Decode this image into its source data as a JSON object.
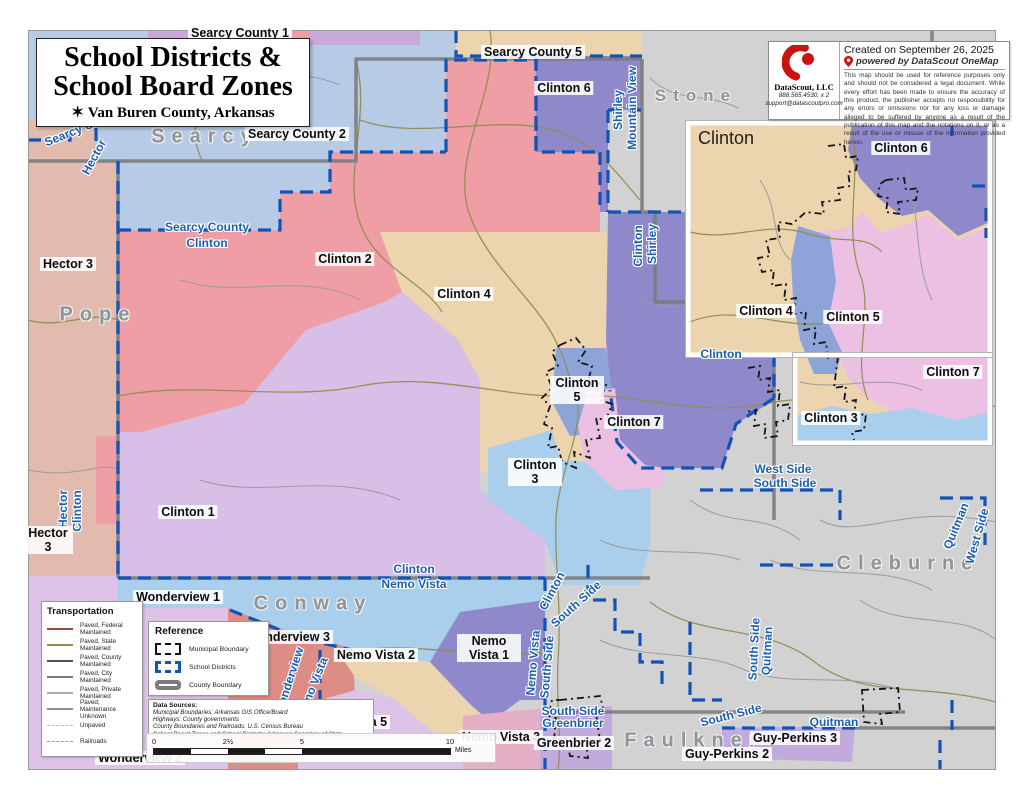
{
  "title_block": {
    "line1": "School Districts &",
    "line2": "School Board Zones",
    "north_icon": "✶",
    "subtitle": "Van Buren County, Arkansas"
  },
  "credit_block": {
    "created": "Created on September 26, 2025",
    "powered": "powered by DataScout OneMap",
    "company": "DataScout, LLC",
    "phone": "888.565.4530, x 2",
    "email": "support@datascoutpro.com",
    "disclaimer": "This map should be used for reference purposes only and should not be considered a legal document.  While every effort has been made to ensure the accuracy of this product, the publisher accepts no responsibility for any errors or omissions nor for any loss or damage alleged to be suffered by anyone as a result of the publication of this map and the notations on it, or as a result of the use or misuse of the information provided herein."
  },
  "legend_transportation": {
    "title": "Transportation",
    "items": [
      {
        "label": "Paved, Federal Maintained"
      },
      {
        "label": "Paved, State Maintained"
      },
      {
        "label": "Paved, County Maintained"
      },
      {
        "label": "Paved, City Maintained"
      },
      {
        "label": "Paved, Private Maintained"
      },
      {
        "label": "Paved, Maintenance Unknown"
      },
      {
        "label": "Unpaved"
      },
      {
        "label": "Railroads"
      }
    ]
  },
  "legend_reference": {
    "title": "Reference",
    "items": [
      {
        "label": "Municipal Boundary"
      },
      {
        "label": "School Districts"
      },
      {
        "label": "County Boundary"
      }
    ]
  },
  "data_sources": {
    "title": "Data Sources:",
    "lines": [
      "Municipal Boundaries: Arkansas GIS Office/Board",
      "Highways: County governments",
      "County Boundaries and Railroads: U.S. Census Bureau",
      "School Board Zones and School Districts: Arkansas Secretary of State"
    ]
  },
  "scale_bar": {
    "ticks": [
      "0",
      "2½",
      "5",
      "10"
    ],
    "unit": "Miles"
  },
  "county_labels": [
    {
      "text": "Searcy"
    },
    {
      "text": "Pope"
    },
    {
      "text": "Stone"
    },
    {
      "text": "Conway"
    },
    {
      "text": "Cleburne"
    },
    {
      "text": "Faulkner"
    }
  ],
  "district_labels": [
    {
      "text": "Searcy County"
    },
    {
      "text": "Hector"
    },
    {
      "text": "Searcy County"
    },
    {
      "text": "Clinton"
    },
    {
      "text": "Shirley"
    },
    {
      "text": "Mountain View"
    },
    {
      "text": "Clinton"
    },
    {
      "text": "Shirley"
    },
    {
      "text": "Hector"
    },
    {
      "text": "Clinton"
    },
    {
      "text": "Clinton"
    },
    {
      "text": "Nemo Vista"
    },
    {
      "text": "West Side"
    },
    {
      "text": "South Side"
    },
    {
      "text": "Clinton"
    },
    {
      "text": "South Side"
    },
    {
      "text": "Nemo Vista"
    },
    {
      "text": "South Side"
    },
    {
      "text": "South Side"
    },
    {
      "text": "Quitman"
    },
    {
      "text": "Quitman"
    },
    {
      "text": "West Side"
    },
    {
      "text": "South Side"
    },
    {
      "text": "Greenbrier"
    },
    {
      "text": "South Side"
    },
    {
      "text": "Quitman"
    },
    {
      "text": "Wonderview"
    },
    {
      "text": "Nemo Vista"
    }
  ],
  "zone_labels": [
    {
      "text": "Searcy County 1"
    },
    {
      "text": "Searcy County 5"
    },
    {
      "text": "Clinton 6"
    },
    {
      "text": "Searcy County 2"
    },
    {
      "text": "Clinton 2"
    },
    {
      "text": "Clinton 4"
    },
    {
      "text": "Clinton 5"
    },
    {
      "text": "Clinton 7"
    },
    {
      "text": "Clinton 3"
    },
    {
      "text": "Clinton 1"
    },
    {
      "text": "Hector 3"
    },
    {
      "text": "Hector 3"
    },
    {
      "text": "Wonderview 1"
    },
    {
      "text": "Wonderview 3"
    },
    {
      "text": "Nemo Vista 2"
    },
    {
      "text": "Nemo Vista 1"
    },
    {
      "text": "Nemo Vista 5"
    },
    {
      "text": "Nemo Vista 3"
    },
    {
      "text": "Wonderview 2"
    },
    {
      "text": "Greenbrier 2"
    },
    {
      "text": "Guy-Perkins 2"
    },
    {
      "text": "Guy-Perkins 3"
    }
  ],
  "inset": {
    "title": "Clinton",
    "district_label": "Clinton",
    "zone_labels": [
      {
        "text": "Clinton 6"
      },
      {
        "text": "Clinton 4"
      },
      {
        "text": "Clinton 5"
      },
      {
        "text": "Clinton 7"
      },
      {
        "text": "Clinton 3"
      }
    ]
  },
  "colors": {
    "county_other": "#d2d2d2",
    "searcy_blue": "#b7cbe6",
    "clinton2_pink": "#ee9ea4",
    "clinton4_tan": "#ecd4af",
    "clinton1_lavender": "#d7bfe7",
    "clinton6_purple": "#8f88ca",
    "clinton5_blue": "#8ea4d9",
    "clinton7_pink": "#ecc0e3",
    "clinton3_lightblue": "#a9cfec",
    "hector_rose": "#e3bbae",
    "conway_salmon": "#dd8d85",
    "nemovista5_lavender": "#ddc3e8",
    "nemovista3_pink": "#e5afc6",
    "greenbrier_purple": "#c2abdc",
    "searcy1_lavender": "#c9a8dc",
    "district_boundary_blue": "#1353b5",
    "county_boundary_gray": "#7c7c7c",
    "label_blue": "#1d5fae",
    "brand_red": "#cc1111"
  }
}
